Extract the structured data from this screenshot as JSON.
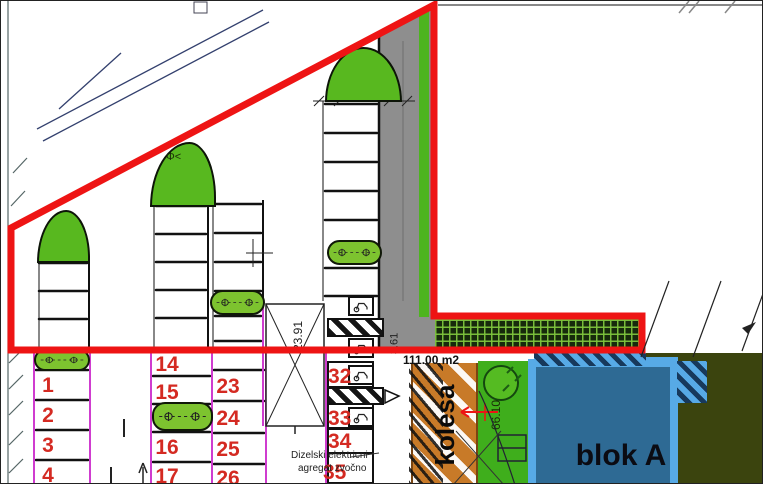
{
  "labels": {
    "building": "blok A",
    "bike_path": "kolesa",
    "area": "111.00 m2",
    "dim_transformer": "23.91",
    "dim_road": "3.61",
    "dim_green": "66.10",
    "note_line1": "Dizelski elektricni",
    "note_line2": "agregat zvočno",
    "tree_symbol": "Φ<"
  },
  "parking_numbers": {
    "col_a": [
      "1",
      "2",
      "3",
      "4"
    ],
    "col_b": [
      "14",
      "15",
      "16",
      "17"
    ],
    "col_c": [
      "23",
      "24",
      "25",
      "26"
    ],
    "col_d": [
      "32",
      "33",
      "34",
      "35"
    ]
  },
  "icons": {
    "trolley": "trolley-icon",
    "tree": "tree-symbol-icon",
    "north_arrow": "up-arrow-icon"
  },
  "colors": {
    "boundary_red": "#ee1414",
    "grass_green": "#58b81f",
    "island_green": "#7dc32f",
    "road_gray": "#8e8e8e",
    "strip_green": "#4db41f",
    "bike_orange": "#c87a28",
    "building_fill": "#2e6a94",
    "building_border": "#57aae6",
    "olive": "#3b440e",
    "lawn": "#3fae1c",
    "magenta": "#cf3ccf",
    "number_red": "#d42a22"
  }
}
